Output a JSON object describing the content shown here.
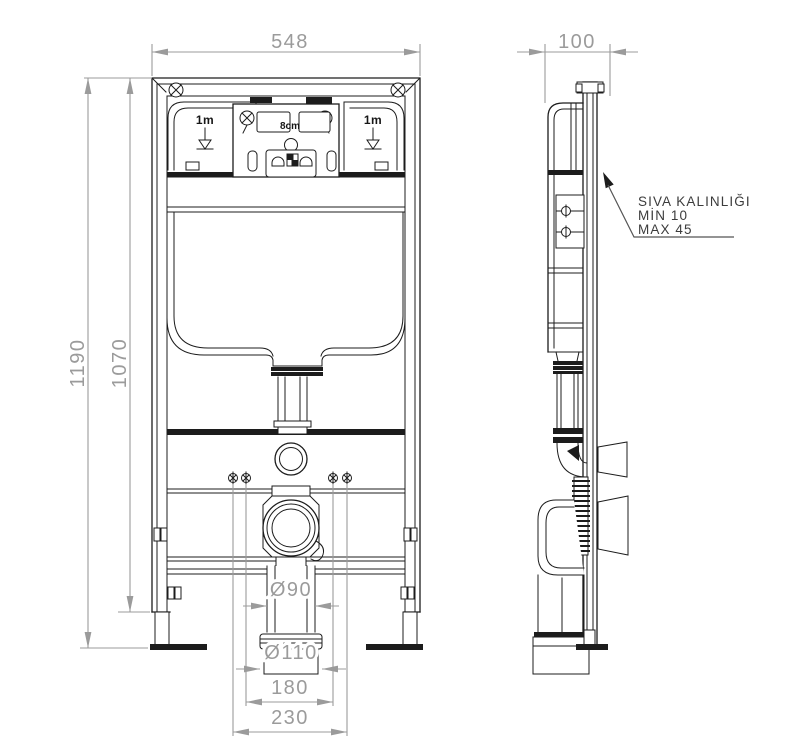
{
  "drawing": {
    "type": "technical-installation-drawing",
    "subject": "concealed-cistern-wc-frame",
    "colors": {
      "outline": "#1c1c1c",
      "dimension": "#9b9b9b",
      "note_text": "#3c3c3c",
      "background": "#ffffff"
    },
    "front_view": {
      "dimensions": {
        "frame_width": "548",
        "total_height": "1190",
        "frame_height": "1070",
        "drain_pipe_diameter": "Ø90",
        "drain_coupling_diameter": "Ø110",
        "spacing_inner": "180",
        "spacing_outer": "230"
      },
      "labels": {
        "level_mark_left": "1m",
        "level_mark_right": "1m",
        "flush_plate_depth": "8cm"
      }
    },
    "side_view": {
      "dimensions": {
        "frame_depth": "100"
      },
      "note": {
        "line1": "SIVA KALINLIĞI",
        "line2": "MİN 10",
        "line3": "MAX 45"
      }
    }
  }
}
